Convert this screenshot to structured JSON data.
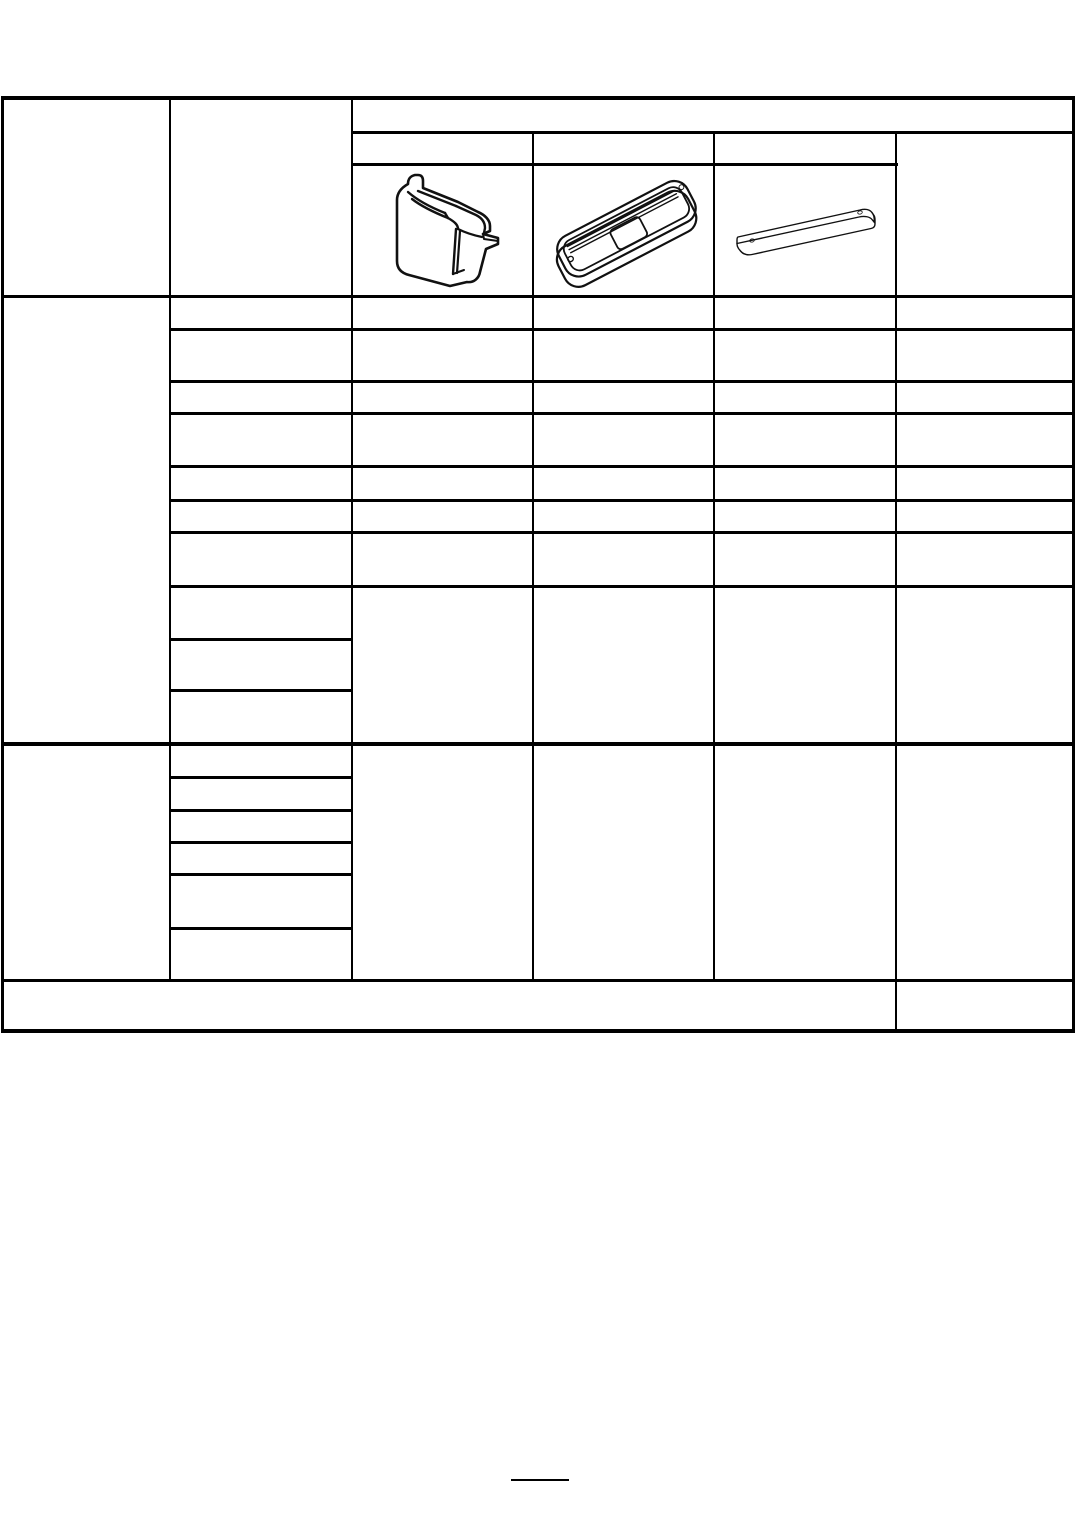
{
  "document": {
    "kind": "scanned blank parts-catalog table page",
    "background_color": "#ffffff",
    "line_color": "#000000"
  },
  "table": {
    "header": {
      "col1_label": "",
      "col2_label": "",
      "top_band_label": "",
      "part_col_labels": [
        "",
        "",
        ""
      ],
      "remarks_label": "",
      "part_images": [
        {
          "name": "suitcase-weight-drawing",
          "description": "isometric line drawing of a blocky cap/weight with top handle slot and right-side clip tab"
        },
        {
          "name": "lamp-assembly-drawing",
          "description": "isometric line drawing of an elongated rounded lamp lens with ribbed face, center pad and two screw holes"
        },
        {
          "name": "mounting-plate-drawing",
          "description": "isometric line drawing of a thin flat bar with a small hole near each end"
        }
      ]
    },
    "section1_rows": [
      "",
      "",
      "",
      "",
      "",
      "",
      ""
    ],
    "section1_col2_subrows": [
      "",
      "",
      ""
    ],
    "section2_col2_subrows": [
      "",
      "",
      "",
      "",
      "",
      ""
    ],
    "footer_row": {
      "left": "",
      "right": ""
    }
  },
  "grid": {
    "vlines": [
      [
        1,
        96,
        3,
        937
      ],
      [
        169,
        96,
        2,
        886
      ],
      [
        351,
        96,
        2,
        886
      ],
      [
        532,
        131,
        2,
        851
      ],
      [
        713,
        131,
        2,
        851
      ],
      [
        895,
        131,
        2,
        901
      ],
      [
        1072,
        96,
        3,
        937
      ]
    ],
    "hlines": [
      [
        1,
        96,
        1074,
        4
      ],
      [
        351,
        131,
        724,
        3
      ],
      [
        351,
        163,
        547,
        3
      ],
      [
        1,
        295,
        1074,
        3
      ],
      [
        169,
        328,
        906,
        3
      ],
      [
        169,
        380,
        906,
        3
      ],
      [
        169,
        412,
        906,
        3
      ],
      [
        169,
        465,
        906,
        3
      ],
      [
        169,
        499,
        906,
        3
      ],
      [
        169,
        531,
        906,
        3
      ],
      [
        169,
        585,
        906,
        3
      ],
      [
        169,
        638,
        184,
        3
      ],
      [
        169,
        689,
        184,
        3
      ],
      [
        1,
        742,
        1074,
        4
      ],
      [
        169,
        776,
        184,
        3
      ],
      [
        169,
        809,
        184,
        3
      ],
      [
        169,
        841,
        184,
        3
      ],
      [
        169,
        873,
        184,
        3
      ],
      [
        169,
        927,
        184,
        3
      ],
      [
        1,
        979,
        1074,
        3
      ],
      [
        1,
        1029,
        1074,
        4
      ]
    ]
  },
  "footer": {
    "page_number": "",
    "underline": [
      511,
      1479,
      58,
      2
    ]
  }
}
